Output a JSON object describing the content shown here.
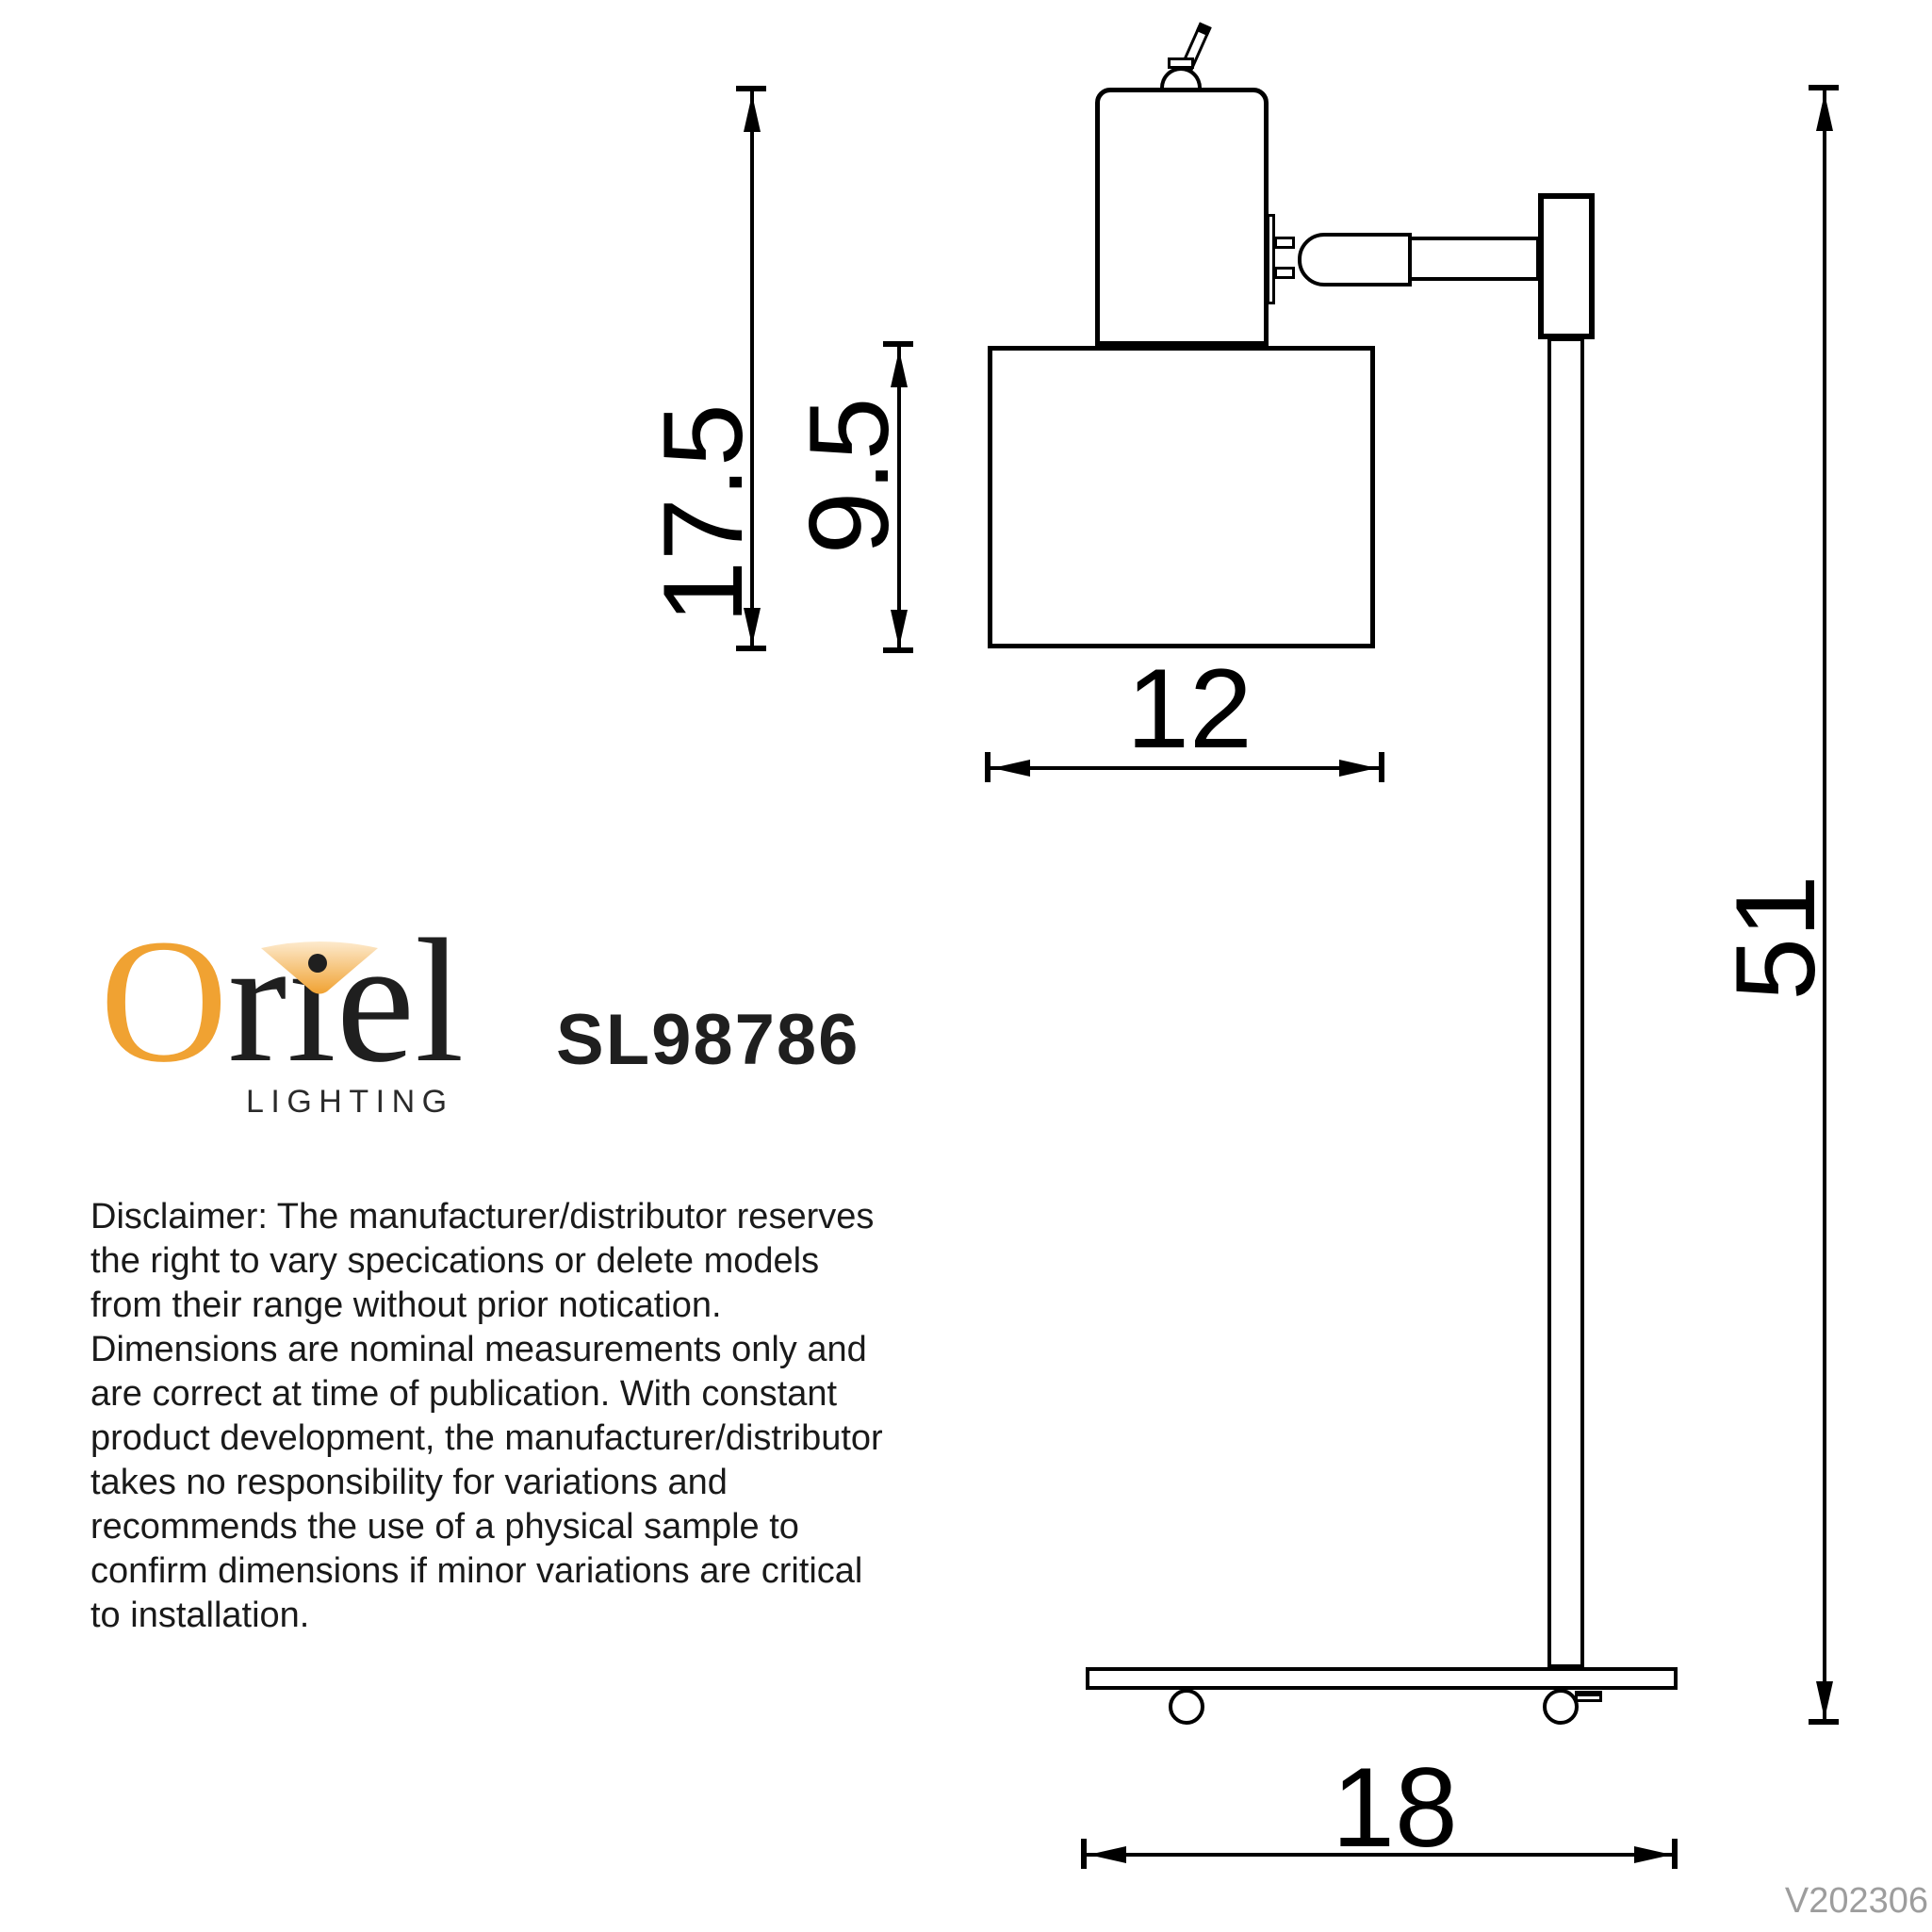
{
  "branding": {
    "brand": "Oriel",
    "tagline": "LIGHTING",
    "model": "SL98786",
    "colors": {
      "brand_orange": "#F0A232",
      "beam_light_orange": "#FDEACD",
      "ink": "#1f1f1f",
      "version_gray": "#9d9d9d",
      "drawing_stroke": "#000000"
    }
  },
  "dimensions": {
    "items": [
      {
        "id": "head-assembly-height",
        "value": "17.5",
        "orientation": "vertical"
      },
      {
        "id": "shade-height",
        "value": "9.5",
        "orientation": "vertical"
      },
      {
        "id": "shade-width",
        "value": "12",
        "orientation": "horizontal"
      },
      {
        "id": "overall-height",
        "value": "51",
        "orientation": "vertical"
      },
      {
        "id": "base-width",
        "value": "18",
        "orientation": "horizontal"
      }
    ]
  },
  "disclaimer": {
    "text": "Disclaimer: The manufacturer/distributor reserves\nthe right to vary specications or delete models\nfrom their range without prior notication.\nDimensions are nominal measurements only and\nare correct at time of publication. With constant\nproduct development, the manufacturer/distributor\ntakes no responsibility for variations and\nrecommends the use of a physical sample to\nconfirm dimensions if minor variations are critical\nto installation."
  },
  "version": {
    "label": "V202306"
  }
}
